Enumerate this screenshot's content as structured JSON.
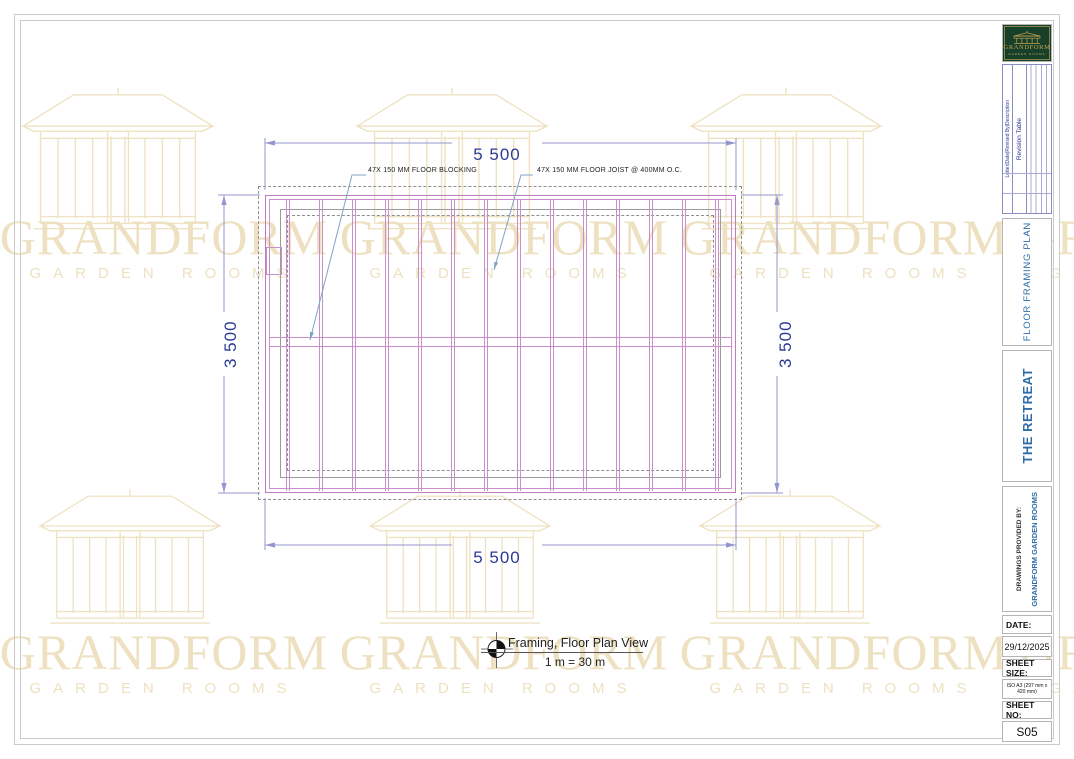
{
  "page": {
    "watermark": {
      "brand": "GRANDFORM",
      "sub": "GARDEN ROOMS"
    },
    "drawing": {
      "dim_width_top": "5 500",
      "dim_width_bottom": "5 500",
      "dim_height_left": "3 500",
      "dim_height_right": "3 500",
      "annotation_blocking": "47X 150 MM FLOOR BLOCKING",
      "annotation_joist": "47X 150 MM FLOOR JOIST @ 400MM O.C.",
      "joist_count": 14,
      "caption_title": "Framing, Floor Plan View",
      "caption_scale": "1 m = 30 m"
    },
    "titleblock": {
      "logo_brand": "GRANDFORM",
      "logo_sub": "GARDEN ROOMS",
      "revision_headers": "Letter|Date|Revised By|Description",
      "revision_title": "Revision Table",
      "plan_title": "FLOOR FRAMING PLAN",
      "project_title": "THE RETREAT",
      "provided_by_label": "DRAWINGS PROVIDED BY:",
      "provided_by_value": "GRANDFORM GARDEN ROOMS",
      "date_label": "DATE:",
      "date_value": "29/12/2025",
      "sheet_size_label": "SHEET SIZE:",
      "sheet_size_value": "ISO A3 (297 mm x 420 mm)",
      "sheet_no_label": "SHEET NO:",
      "sheet_no_value": "S05"
    },
    "colors": {
      "framing_pink": "#c98fc9",
      "dim_blue": "#2b3a96",
      "wm_tan": "#eee1c1",
      "logo_green": "#17402b",
      "logo_gold": "#c8a451",
      "title_blue": "#2f6da8"
    }
  }
}
